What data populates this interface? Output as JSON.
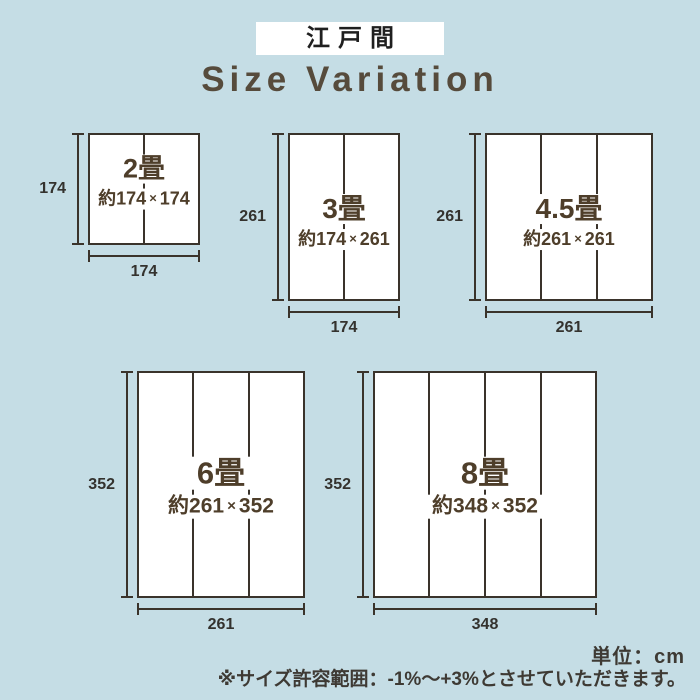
{
  "header": {
    "tag": "江戸間",
    "title": "Size Variation"
  },
  "footer": {
    "unit_note": "単位：cm",
    "tolerance_note": "※サイズ許容範囲：-1%〜+3%とさせていただきます。"
  },
  "colors": {
    "background": "#c5dde5",
    "line": "#3a332b",
    "mat_fill": "#ffffff",
    "tag_bg": "#ffffff",
    "tag_text": "#1f1f1f",
    "title_text": "#564b3c",
    "label_text": "#4e3e2a",
    "dim_text": "#34322e",
    "note_text": "#3e3a34"
  },
  "sizes": [
    {
      "id": "2jo",
      "label": "2畳",
      "dims_label": "約174×174",
      "width_cm": 174,
      "height_cm": 174,
      "panels": 2,
      "side_dim": "174",
      "bottom_dim": "174"
    },
    {
      "id": "3jo",
      "label": "3畳",
      "dims_label": "約174×261",
      "width_cm": 174,
      "height_cm": 261,
      "panels": 2,
      "side_dim": "261",
      "bottom_dim": "174"
    },
    {
      "id": "4_5jo",
      "label": "4.5畳",
      "dims_label": "約261×261",
      "width_cm": 261,
      "height_cm": 261,
      "panels": 3,
      "side_dim": "261",
      "bottom_dim": "261"
    },
    {
      "id": "6jo",
      "label": "6畳",
      "dims_label": "約261×352",
      "width_cm": 261,
      "height_cm": 352,
      "panels": 3,
      "side_dim": "352",
      "bottom_dim": "261"
    },
    {
      "id": "8jo",
      "label": "8畳",
      "dims_label": "約348×352",
      "width_cm": 348,
      "height_cm": 352,
      "panels": 4,
      "side_dim": "352",
      "bottom_dim": "348"
    }
  ]
}
